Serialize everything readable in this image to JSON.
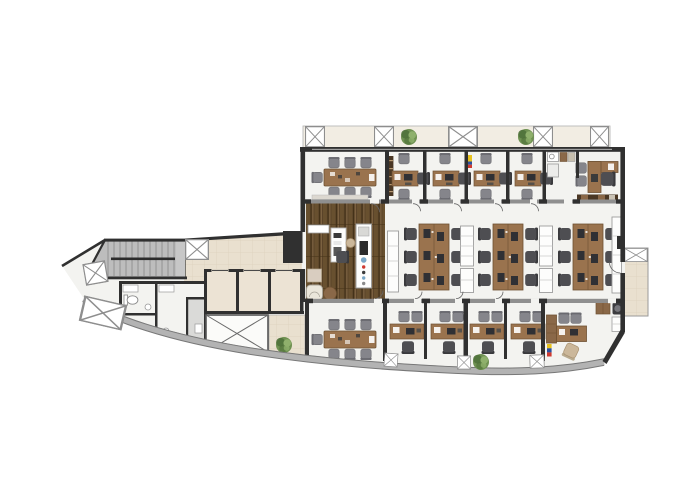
{
  "app": {
    "type": "architectural-floor-plan",
    "view": "top-down plan",
    "label": "Office floor plan"
  },
  "palette": {
    "wall": "#303030",
    "outline": "#222222",
    "floor": "#f3f3f0",
    "tile": "#e9e0cf",
    "tile_line": "#ddd2bc",
    "wood_a": "#5a4329",
    "wood_b": "#68502f",
    "wood_c": "#7b6140",
    "wood_gap": "#423016",
    "desk": "#9a734e",
    "desk_edge": "#6e5132",
    "dark_wood": "#4a3724",
    "mid_wood": "#8a6848",
    "glass": "#8f8f8f",
    "band": "#b3b3b3",
    "band_edge": "#787878",
    "stairs": "#bdbdbd",
    "stair_line": "#8d8d8d",
    "chair_dark": "#4e4e52",
    "chair_back": "#39393c",
    "chair_mid": "#85858b",
    "cabinet_line": "#9d9d9d",
    "cream": "#f2ede3",
    "plant": "#6f9152",
    "plant_dark": "#4e7039",
    "plant_light": "#8fb06c",
    "upholstery": "#eae6db",
    "tan": "#cbb79a",
    "printer": "#3d3d40",
    "appliance": "#2b2b2b",
    "flag_yellow": "#e8c21d",
    "flag_blue": "#2b4f9e",
    "flag_red": "#cf3a30",
    "white": "#ffffff",
    "shaft_line": "#565656",
    "accent_blue": "#7aa7c7"
  },
  "plan": {
    "zones": [
      {
        "id": "north-ledge",
        "label": "north facade ledge",
        "items": [
          "structural column x5",
          "planter x2"
        ]
      },
      {
        "id": "conference-room-north",
        "label": "north conference room",
        "items": [
          "8-seat conference table"
        ]
      },
      {
        "id": "office-n1",
        "label": "private office",
        "items": [
          "desk",
          "task chair",
          "2 guest chairs",
          "bookshelf"
        ]
      },
      {
        "id": "office-n2",
        "label": "private office",
        "items": [
          "desk",
          "task chair",
          "2 guest chairs"
        ]
      },
      {
        "id": "office-n3",
        "label": "private office",
        "items": [
          "desk",
          "task chair",
          "2 guest chairs",
          "wall flag"
        ]
      },
      {
        "id": "office-n4",
        "label": "private office",
        "items": [
          "desk",
          "task chair",
          "2 guest chairs"
        ]
      },
      {
        "id": "coffee-point",
        "label": "coffee point",
        "items": [
          "sink counter",
          "coffee machine",
          "base cabinet"
        ]
      },
      {
        "id": "corner-office-ne",
        "label": "northeast corner office",
        "items": [
          "L-shaped desk",
          "executive chair",
          "2 guest chairs",
          "credenza"
        ]
      },
      {
        "id": "reception-lounge",
        "label": "reception lounge on dark wood floor",
        "items": [
          "reception desk",
          "task chair",
          "stool",
          "tall vending unit",
          "armchair",
          "side table",
          "round table",
          "sideboard"
        ]
      },
      {
        "id": "open-plan",
        "label": "open plan workspace",
        "items": [
          "6-seat bench desk x3",
          "storage cabinet x5",
          "wall counter"
        ]
      },
      {
        "id": "east-balcony",
        "label": "east balcony",
        "items": [
          "structural column"
        ]
      },
      {
        "id": "conference-room-south",
        "label": "south conference room",
        "items": [
          "8-seat conference table"
        ]
      },
      {
        "id": "office-s1",
        "label": "private office",
        "items": [
          "desk",
          "task chair",
          "2 guest chairs"
        ]
      },
      {
        "id": "office-s2",
        "label": "private office",
        "items": [
          "desk",
          "task chair",
          "2 guest chairs"
        ]
      },
      {
        "id": "office-s3",
        "label": "private office",
        "items": [
          "desk",
          "task chair",
          "2 guest chairs"
        ]
      },
      {
        "id": "office-s4",
        "label": "private office",
        "items": [
          "desk",
          "task chair",
          "2 guest chairs"
        ]
      },
      {
        "id": "corner-office-se",
        "label": "southeast corner office",
        "items": [
          "desk",
          "executive chair",
          "2 guest chairs",
          "tall cabinet",
          "printer",
          "storage cabinets",
          "wall flag"
        ]
      },
      {
        "id": "stair-core",
        "label": "staircase",
        "items": [
          "double-flight stair",
          "handrail"
        ]
      },
      {
        "id": "elevator-lobby",
        "label": "elevator lobby",
        "items": [
          "elevator cab x3",
          "service shaft",
          "structural column"
        ]
      },
      {
        "id": "restrooms",
        "label": "restrooms",
        "items": [
          "toilet x2",
          "vanity x2",
          "sink x2",
          "utility room"
        ]
      },
      {
        "id": "south-terrace",
        "label": "south terrace",
        "items": [
          "planter"
        ]
      },
      {
        "id": "curved-facade",
        "label": "curved glass south facade",
        "items": [
          "structural column x4",
          "planter"
        ]
      }
    ],
    "counts": {
      "conference_rooms": 2,
      "private_offices": 8,
      "corner_offices": 2,
      "open_plan_bench_desks": 3,
      "seats_per_bench": 6,
      "elevators": 3,
      "restroom_toilets": 2,
      "structural_columns": 11,
      "planters": 4,
      "stair_flights": 2
    }
  }
}
